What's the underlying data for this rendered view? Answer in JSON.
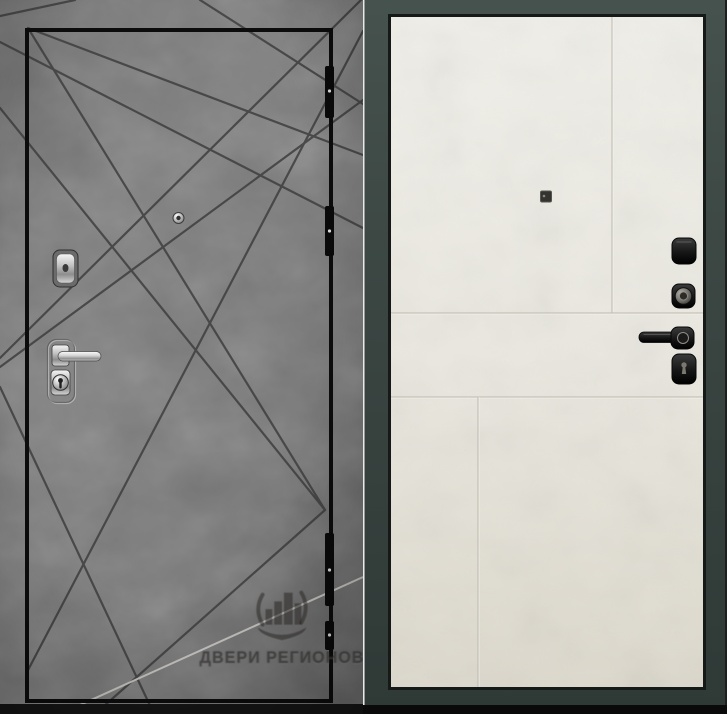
{
  "left_panel": {
    "watermark_text": "ДВЕРИ РЕГИОНОВ",
    "finish": "dark concrete with ray pattern",
    "hardware_icons": [
      "hinge",
      "peephole",
      "keyhole-cover",
      "lever-handle",
      "lock-cylinder"
    ],
    "colors": {
      "wall": "#7a7a7a",
      "pattern_line": "#3c3c3c",
      "highlight_line": "#cbc9c5",
      "leaf_outline": "#0c0c0c",
      "hardware_chrome": "#d8d8d8"
    }
  },
  "right_panel": {
    "watermark_text": "ДВЕРИ РЕГИОНОВ",
    "finish": "light panel with seam lines",
    "hardware_icons": [
      "peephole",
      "latch-cover",
      "thumbturn-knob",
      "lever-handle",
      "keyhole"
    ],
    "colors": {
      "frame": "#3b4643",
      "leaf": "#eae8e1",
      "hardware_black": "#161616",
      "outer_edge": "#1b211f"
    }
  }
}
